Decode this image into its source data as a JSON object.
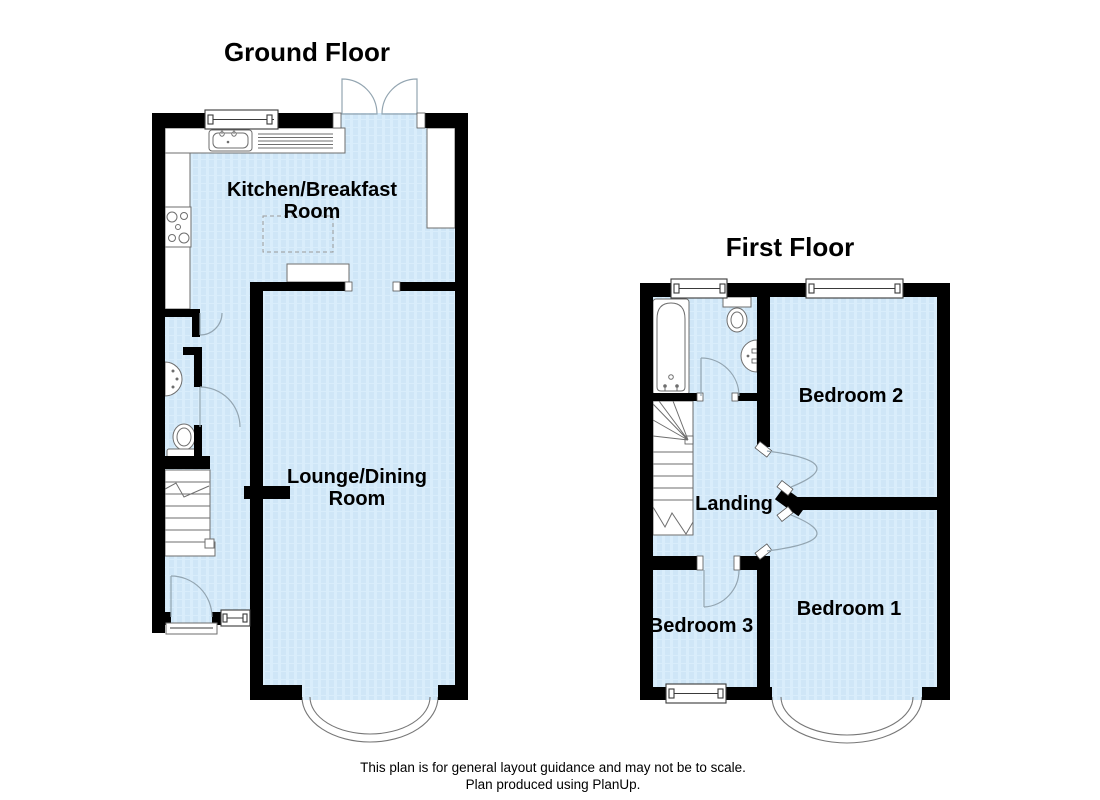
{
  "ground_floor": {
    "title": "Ground Floor",
    "rooms": {
      "kitchen": {
        "line1": "Kitchen/Breakfast",
        "line2": "Room"
      },
      "lounge": {
        "line1": "Lounge/Dining",
        "line2": "Room"
      }
    },
    "fixtures": [
      "kitchen-sink",
      "drainer",
      "hob",
      "worktop",
      "breakfast-table",
      "chimney-breast",
      "wc-toilet",
      "corner-basin",
      "stairs",
      "front-door",
      "french-doors",
      "windows",
      "bay-window"
    ]
  },
  "first_floor": {
    "title": "First Floor",
    "rooms": {
      "bedroom1": {
        "label": "Bedroom 1"
      },
      "bedroom2": {
        "label": "Bedroom 2"
      },
      "bedroom3": {
        "label": "Bedroom 3"
      },
      "landing": {
        "label": "Landing"
      }
    },
    "fixtures": [
      "bath",
      "toilet",
      "basin",
      "stairs",
      "doors",
      "windows",
      "bay-window"
    ]
  },
  "footer": {
    "line1": "This plan is for general layout guidance and may not be to scale.",
    "line2": "Plan produced using PlanUp."
  },
  "colors": {
    "room_fill": "#d9edfb",
    "room_fill_stripe": "#cfe6f7",
    "wall": "#000000",
    "fixture_outline": "#6e6e6e",
    "door_arc": "#93a5b1",
    "text": "#000000"
  }
}
